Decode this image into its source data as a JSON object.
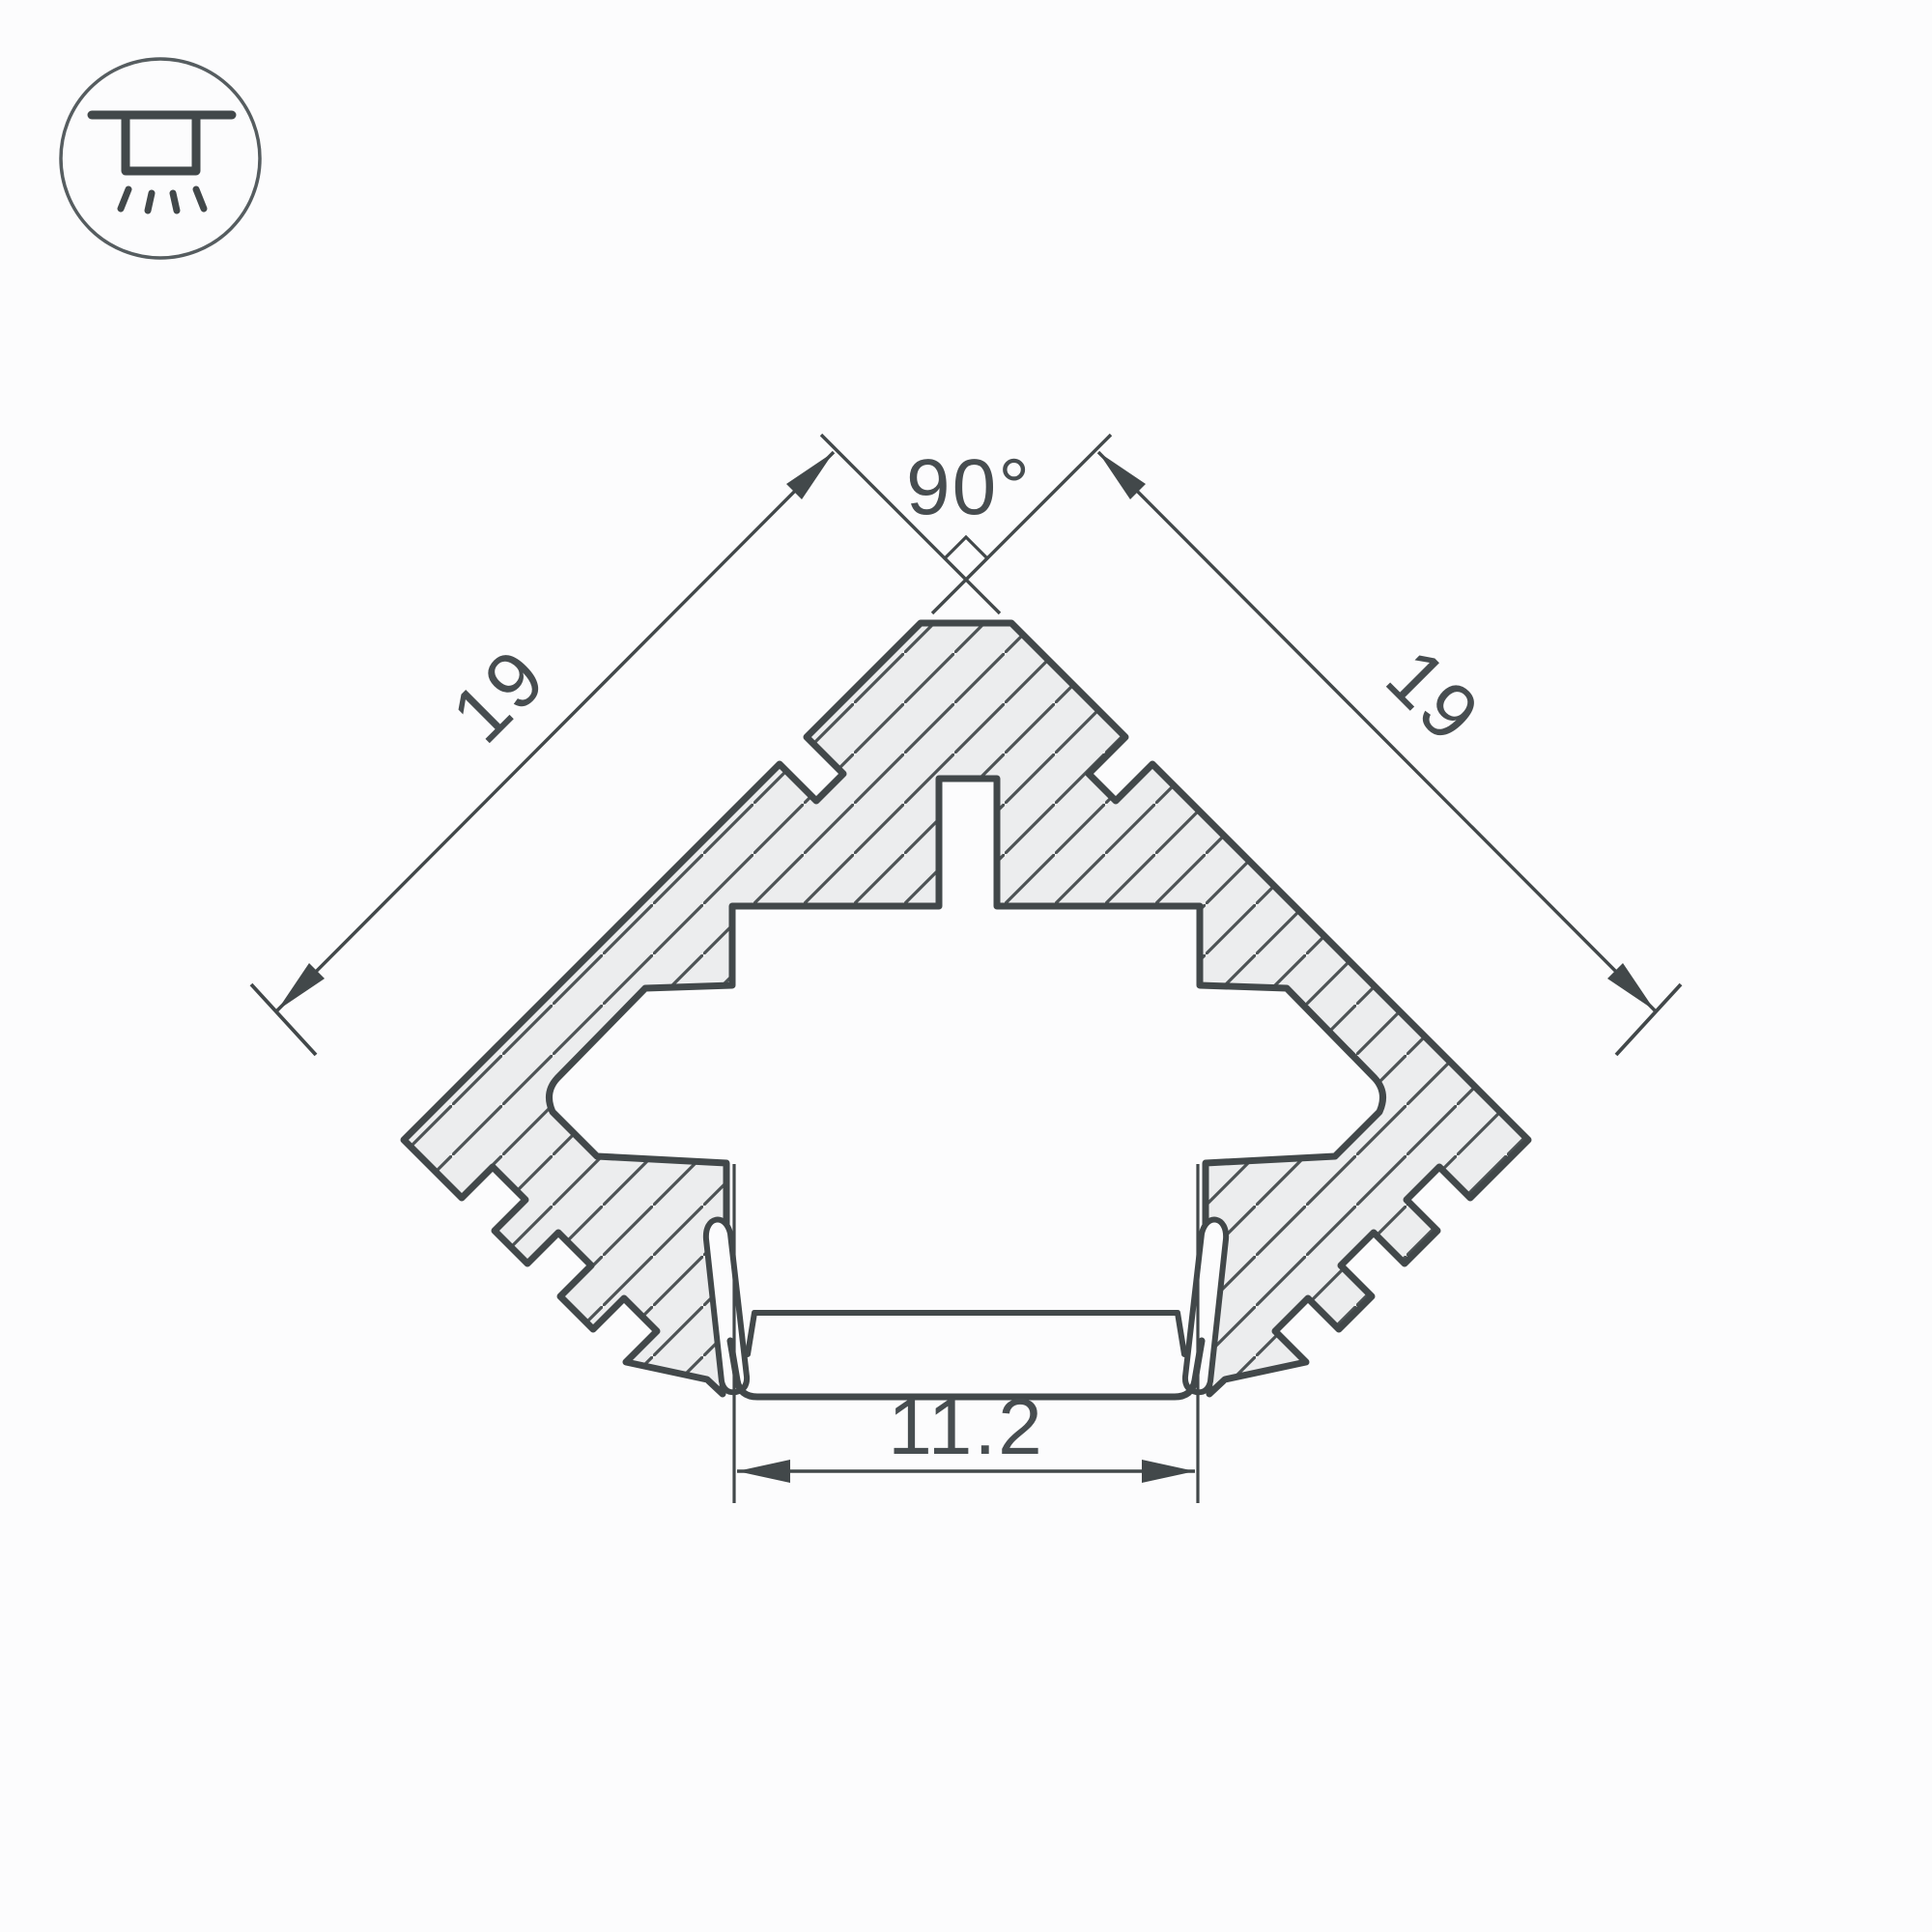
{
  "icon": {
    "name": "recessed-ceiling-light-icon",
    "description": "circled symbol of a recessed ceiling luminaire shining downward"
  },
  "drawing": {
    "type": "technical-cross-section",
    "subject": "90-degree corner aluminium LED profile cross-section with cover clip channel",
    "dimensions": {
      "angle": "90°",
      "side_left": "19",
      "side_right": "19",
      "opening_width": "11.2"
    },
    "colors": {
      "line": "#42484a",
      "body_fill": "#ecedee",
      "hatch": "#4d5355",
      "background": "#fcfcfd",
      "text": "#474d50"
    }
  }
}
